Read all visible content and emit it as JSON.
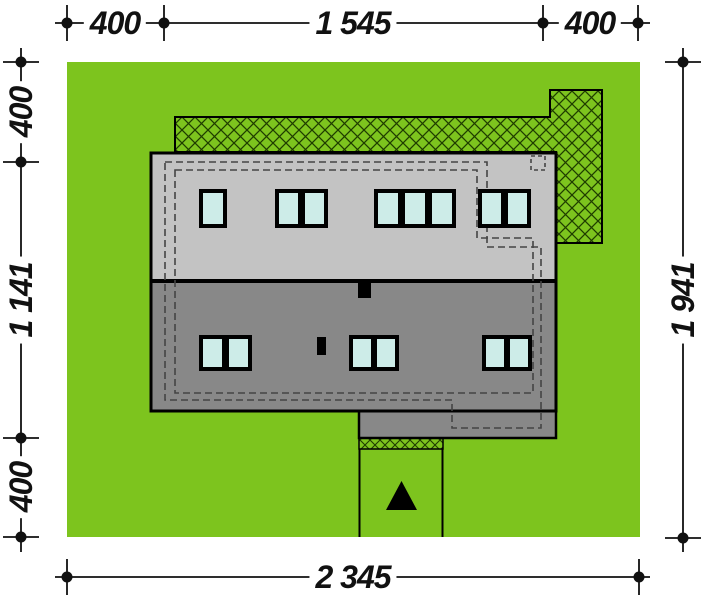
{
  "page": {
    "background": "#ffffff",
    "kind": "house site plan / plot plan"
  },
  "colors": {
    "lawn": "#7dc41e",
    "hatch_line": "#1f3d00",
    "roof_upper": "#c3c3c3",
    "roof_lower": "#888888",
    "window_glass": "#cdece8",
    "outline": "#000000",
    "dashed": "#444444",
    "dim": "#111111",
    "label_bg": "#ffffff"
  },
  "dimensions": {
    "top": {
      "segments": [
        {
          "label": "400"
        },
        {
          "label": "1 545"
        },
        {
          "label": "400"
        }
      ]
    },
    "left": {
      "segments": [
        {
          "label": "400"
        },
        {
          "label": "1 141"
        },
        {
          "label": "400"
        }
      ]
    },
    "right": {
      "segments": [
        {
          "label": "1 941"
        }
      ]
    },
    "bottom": {
      "segments": [
        {
          "label": "2 345"
        }
      ]
    }
  }
}
